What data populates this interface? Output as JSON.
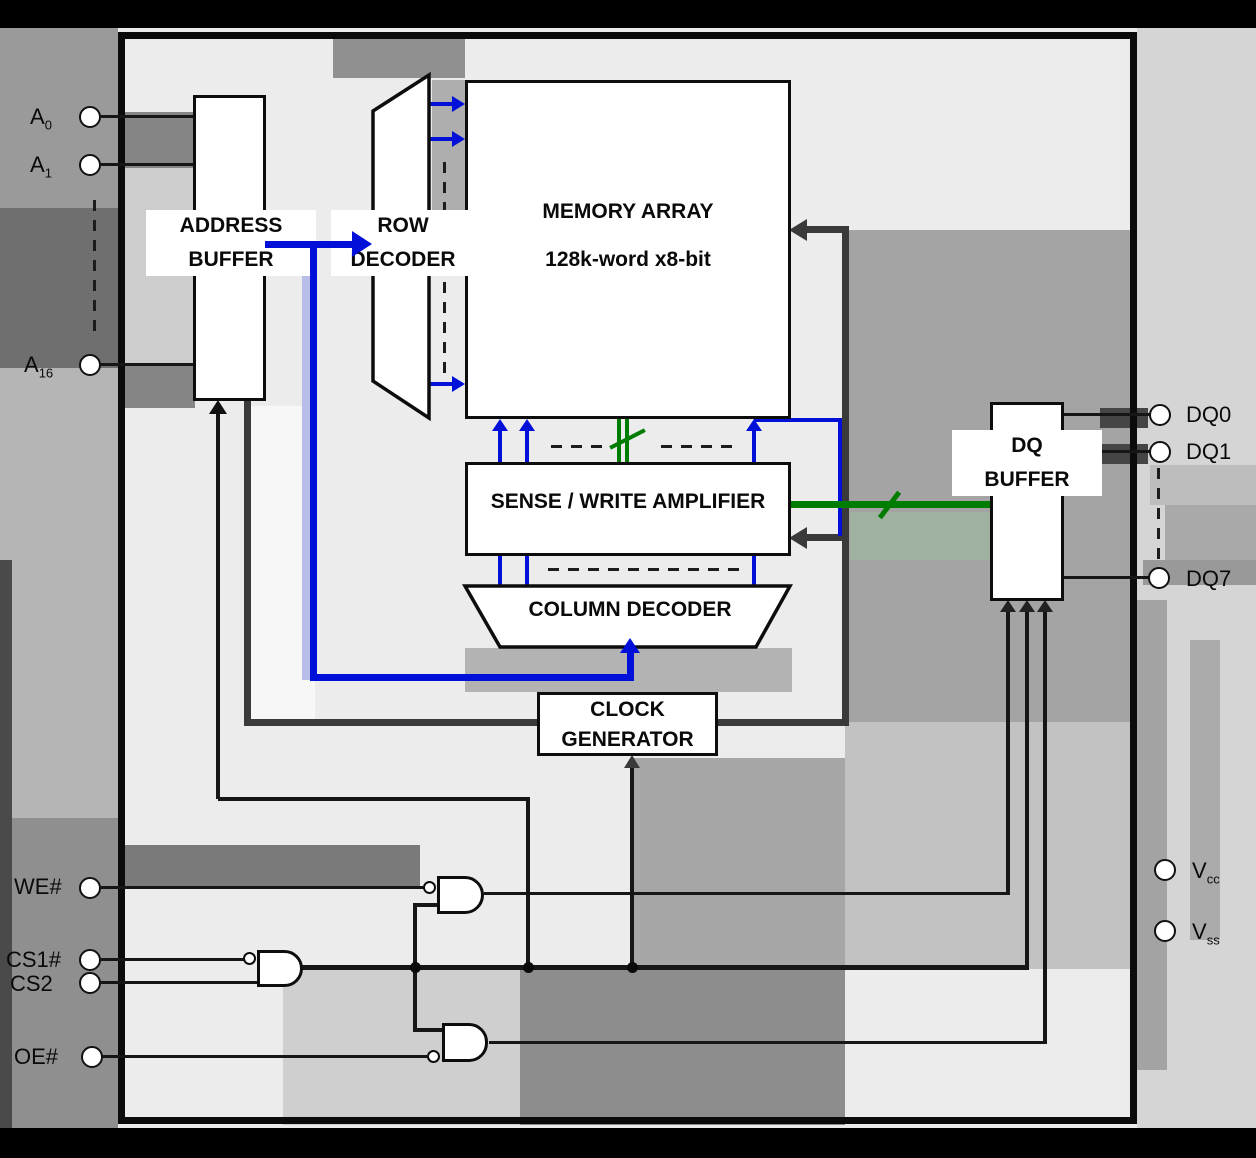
{
  "colors": {
    "line": "#161616",
    "dark": "#3a3a3a",
    "blue": "#0010d8",
    "green": "#007c00"
  },
  "blocks": {
    "address_buffer": {
      "line1": "ADDRESS",
      "line2": "BUFFER"
    },
    "row_decoder": {
      "line1": "ROW",
      "line2": "DECODER"
    },
    "memory_array": {
      "title": "MEMORY ARRAY",
      "subtitle": "128k-word x8-bit"
    },
    "sense_write_amplifier": {
      "label": "SENSE / WRITE AMPLIFIER"
    },
    "column_decoder": {
      "label": "COLUMN DECODER"
    },
    "clock_generator": {
      "line1": "CLOCK",
      "line2": "GENERATOR"
    },
    "dq_buffer": {
      "line1": "DQ",
      "line2": "BUFFER"
    }
  },
  "pins": {
    "left": [
      {
        "id": "A0",
        "base": "A",
        "sub": "0"
      },
      {
        "id": "A1",
        "base": "A",
        "sub": "1"
      },
      {
        "id": "A16",
        "base": "A",
        "sub": "16"
      },
      {
        "id": "WE#",
        "base": "WE#",
        "sub": ""
      },
      {
        "id": "CS1#",
        "base": "CS1#",
        "sub": ""
      },
      {
        "id": "CS2",
        "base": "CS2",
        "sub": ""
      },
      {
        "id": "OE#",
        "base": "OE#",
        "sub": ""
      }
    ],
    "right": [
      {
        "id": "DQ0",
        "base": "DQ0",
        "sub": ""
      },
      {
        "id": "DQ1",
        "base": "DQ1",
        "sub": ""
      },
      {
        "id": "DQ7",
        "base": "DQ7",
        "sub": ""
      },
      {
        "id": "Vcc",
        "base": "V",
        "sub": "cc"
      },
      {
        "id": "Vss",
        "base": "V",
        "sub": "ss"
      }
    ]
  }
}
